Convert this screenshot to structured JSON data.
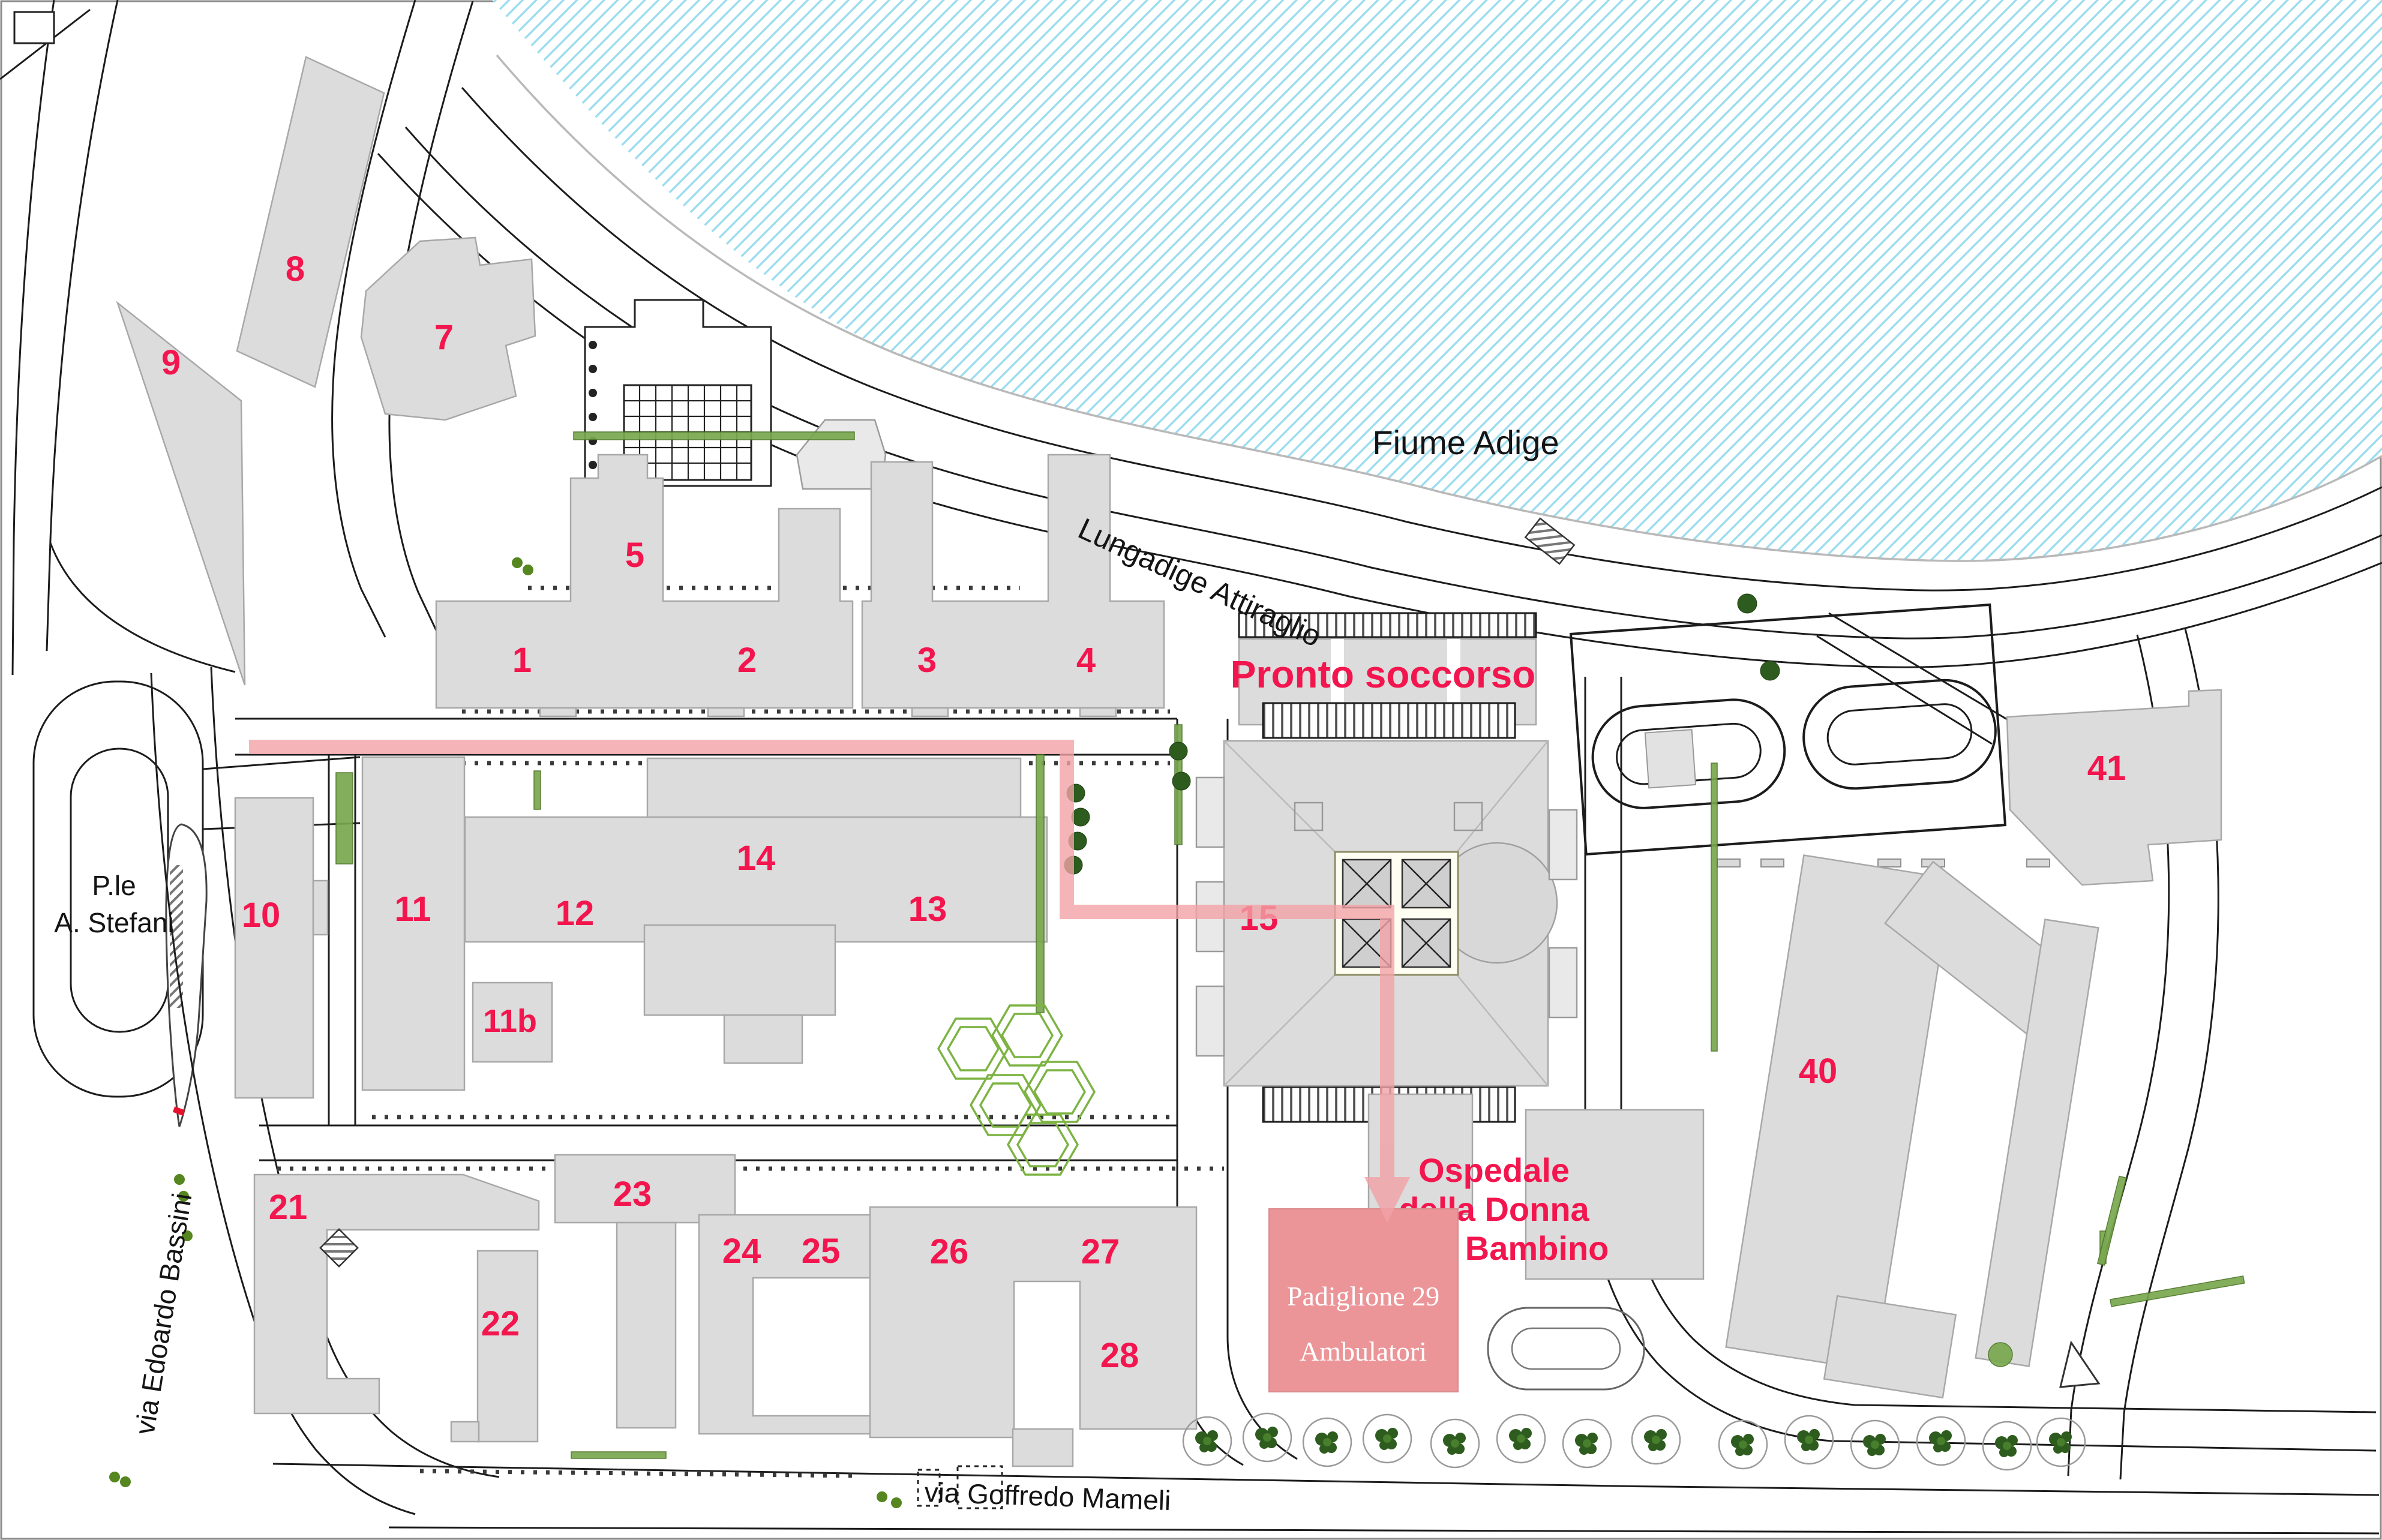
{
  "map_labels": {
    "river": "Fiume Adige",
    "river_road": "Lungadige Attiraglio",
    "square_line1": "P.le",
    "square_line2": "A. Stefani",
    "street_west": "via Edoardo Bassini",
    "street_south": "via Goffredo Mameli",
    "emergency_label": "Pronto soccorso",
    "destination_line1": "Ospedale",
    "destination_line2": "della Donna",
    "destination_line3": "e del Bambino",
    "pavilion_title": "Padiglione 29",
    "pavilion_subtitle": "Ambulatori"
  },
  "building_numbers": [
    "8",
    "9",
    "7",
    "5",
    "1",
    "2",
    "3",
    "4",
    "10",
    "11",
    "12",
    "13",
    "14",
    "11b",
    "15",
    "21",
    "22",
    "23",
    "24",
    "25",
    "26",
    "27",
    "28",
    "40",
    "41"
  ],
  "colors": {
    "number_red": "#f3164e",
    "title_red": "#f3164e",
    "pavilion_fill": "#ec9598",
    "route_pink": "#f2a2a6",
    "river_hatch": "#9adcef",
    "building_fill": "#dcdcdc",
    "green": "#6fa14e",
    "road_line": "#1c1c1c"
  }
}
